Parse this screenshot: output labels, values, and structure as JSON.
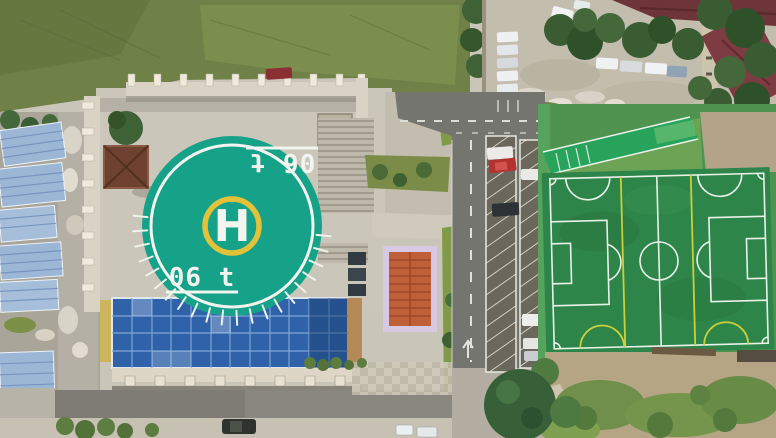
{
  "scene": {
    "description": "Aerial drone photo: teal rooftop helipad with yellow H ring on a large building (left), blue glass atrium roof on its south face, blue-roofed sheds along the left edge, a vertical access road with two angled parking strips and parked cars (center-right), a fenced artificial football pitch with white and yellow markings (right), a car lot with parked cars, trees and dark-red roofed buildings (top-right), grass field (top-left) and dirt ground with weeds (bottom-right).",
    "helipad": {
      "center_letter": "H",
      "weight_limit_bottom": "06 t",
      "weight_limit_top": "06 t"
    },
    "features": [
      "rooftop-helipad",
      "glass-atrium-roof",
      "blue-shed-roofs",
      "gazebo",
      "access-road-with-angled-parking",
      "football-pitch",
      "grandstand-roof",
      "car-lot",
      "red-roof-buildings",
      "grass-field",
      "dirt-with-weeds"
    ],
    "palette": {
      "helipad_deck": "#16a189",
      "helipad_ring": "#e3c23a",
      "marking_white": "#f2f4ef",
      "pitch_turf": "#2e8549",
      "pitch_line": "#e9f2e9",
      "cross_pitch_line": "#cbcf3a",
      "stand_roof": "#27a35c",
      "glass_roof": "#2f62a8",
      "shed_roof": "#9cb6d6",
      "road_asphalt": "#74756f",
      "upper_grass": "#6f8146",
      "dirt": "#b5a585",
      "red_roof": "#6e3538"
    }
  }
}
